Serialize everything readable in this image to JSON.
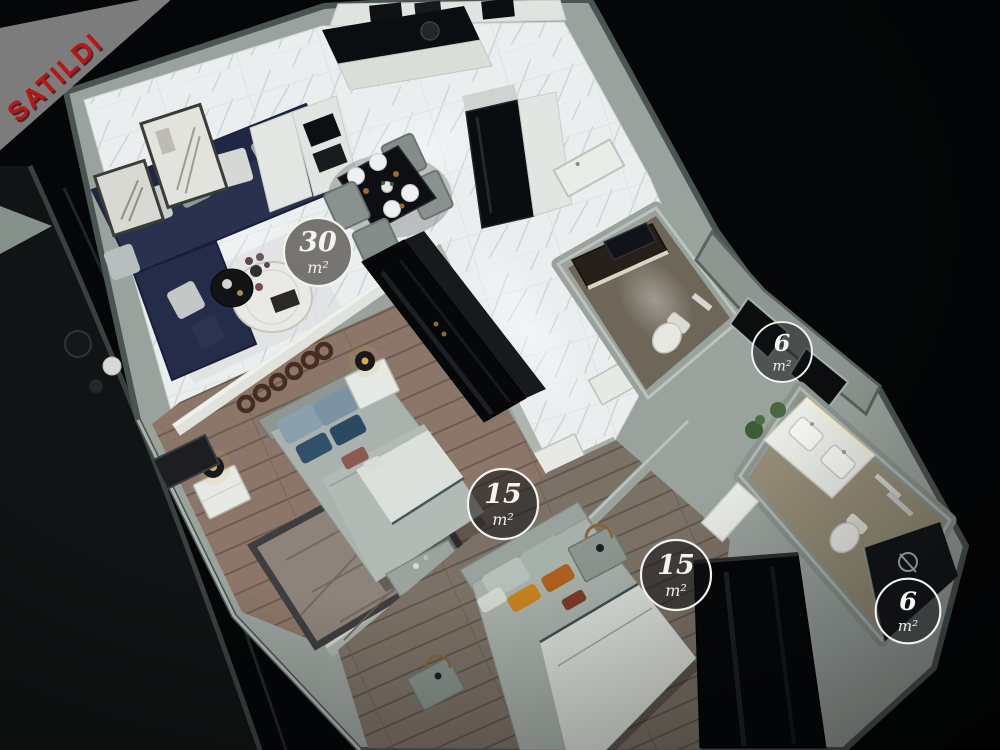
{
  "banner": {
    "label": "SATILDI"
  },
  "area_badges": [
    {
      "value": "30",
      "unit": "m²"
    },
    {
      "value": "6",
      "unit": "m²"
    },
    {
      "value": "15",
      "unit": "m²"
    },
    {
      "value": "15",
      "unit": "m²"
    },
    {
      "value": "6",
      "unit": "m²"
    }
  ],
  "colors": {
    "background": "#050607",
    "ribbon_background": "#7c7c7c",
    "ribbon_text": "#bb1616",
    "wall": "#9aa29e",
    "marble_floor": "#eaeeee",
    "wood_floor_bedroom1": "#8b7669",
    "wood_floor_bedroom2": "#7b7166",
    "sofa": "#29314f",
    "badge_ring": "#f3f3ee"
  }
}
